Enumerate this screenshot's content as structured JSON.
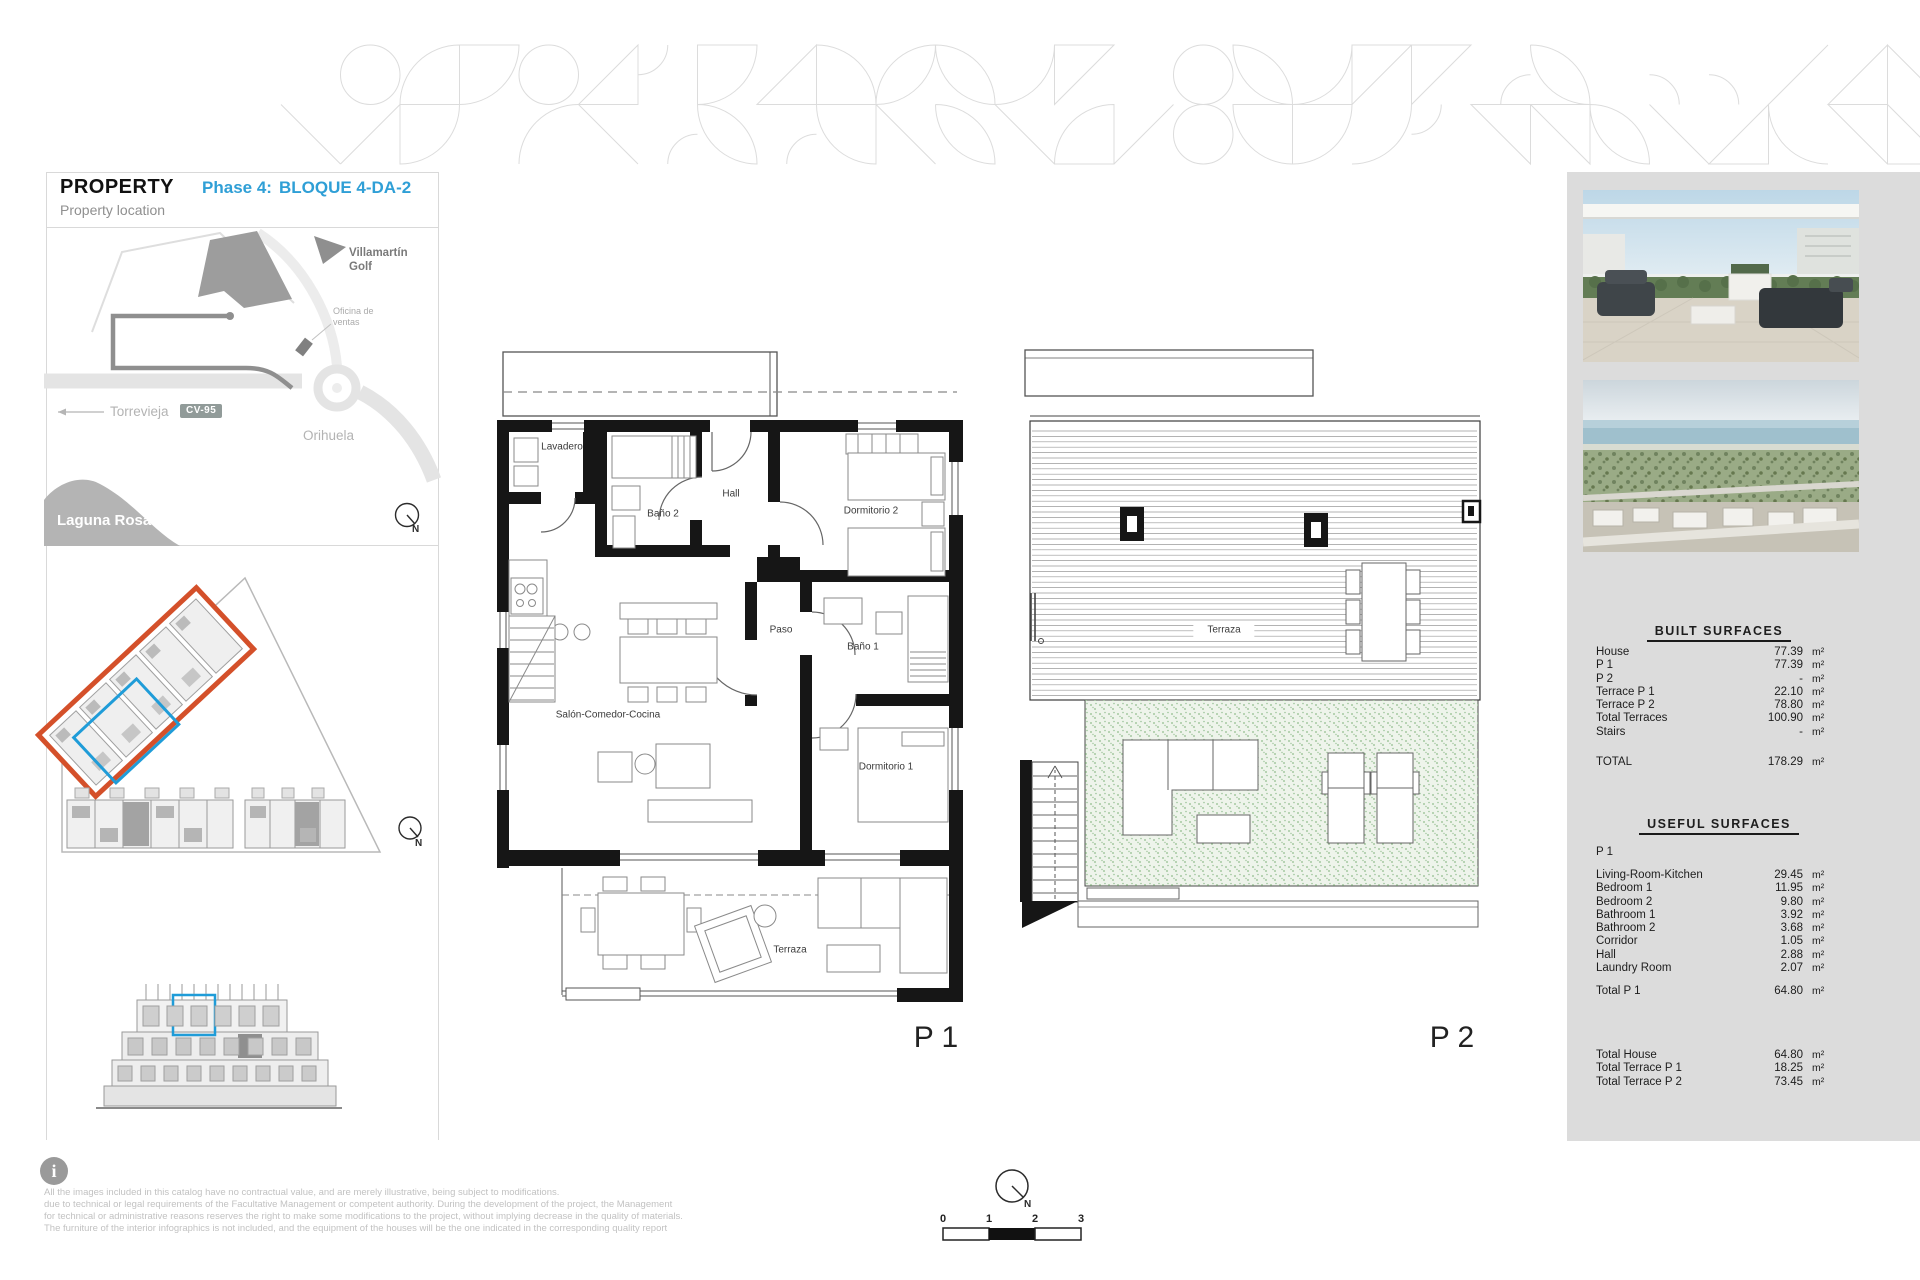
{
  "header": {
    "brand": "PROPERTY",
    "phase_label": "Phase 4:",
    "block_label": "BLOQUE 4-DA-2",
    "subtitle": "Property location"
  },
  "map": {
    "villamartin_line1": "Villamartín",
    "villamartin_line2": "Golf",
    "oficina_line1": "Oficina de",
    "oficina_line2": "ventas",
    "torrevieja": "Torrevieja",
    "road_badge": "CV-95",
    "orihuela": "Orihuela",
    "laguna": "Laguna Rosa",
    "n": "N"
  },
  "plans": {
    "p1": {
      "label": "P 1",
      "rooms": {
        "lavadero": "Lavadero",
        "bano2": "Baño 2",
        "hall": "Hall",
        "dormitorio2": "Dormitorio 2",
        "paso": "Paso",
        "bano1": "Baño 1",
        "dormitorio1": "Dormitorio 1",
        "salon": "Salón-Comedor-Cocina",
        "terraza": "Terraza"
      }
    },
    "p2": {
      "label": "P 2",
      "terraza": "Terraza"
    }
  },
  "built_surfaces": {
    "title": "BUILT SURFACES",
    "rows": [
      {
        "label": "House",
        "value": "77.39",
        "unit": "m²"
      },
      {
        "label": "P 1",
        "value": "77.39",
        "unit": "m²"
      },
      {
        "label": "P 2",
        "value": "-",
        "unit": "m²"
      },
      {
        "label": "Terrace P 1",
        "value": "22.10",
        "unit": "m²"
      },
      {
        "label": "Terrace P 2",
        "value": "78.80",
        "unit": "m²"
      },
      {
        "label": "Total Terraces",
        "value": "100.90",
        "unit": "m²"
      },
      {
        "label": "Stairs",
        "value": "-",
        "unit": "m²"
      }
    ],
    "total": {
      "label": "TOTAL",
      "value": "178.29",
      "unit": "m²"
    }
  },
  "useful_surfaces": {
    "title": "USEFUL SURFACES",
    "section": "P 1",
    "rows": [
      {
        "label": "Living-Room-Kitchen",
        "value": "29.45",
        "unit": "m²"
      },
      {
        "label": "Bedroom 1",
        "value": "11.95",
        "unit": "m²"
      },
      {
        "label": "Bedroom 2",
        "value": "9.80",
        "unit": "m²"
      },
      {
        "label": "Bathroom 1",
        "value": "3.92",
        "unit": "m²"
      },
      {
        "label": "Bathroom 2",
        "value": "3.68",
        "unit": "m²"
      },
      {
        "label": "Corridor",
        "value": "1.05",
        "unit": "m²"
      },
      {
        "label": "Hall",
        "value": "2.88",
        "unit": "m²"
      },
      {
        "label": "Laundry Room",
        "value": "2.07",
        "unit": "m²"
      }
    ],
    "total": {
      "label": "Total P 1",
      "value": "64.80",
      "unit": "m²"
    }
  },
  "summary_totals": {
    "rows": [
      {
        "label": "Total House",
        "value": "64.80",
        "unit": "m²"
      },
      {
        "label": "Total Terrace P 1",
        "value": "18.25",
        "unit": "m²"
      },
      {
        "label": "Total Terrace P 2",
        "value": "73.45",
        "unit": "m²"
      }
    ]
  },
  "disclaimer": {
    "lines": [
      "All the images included in this catalog have no contractual value, and are merely illustrative, being subject to modifications.",
      "due to technical or legal requirements of the Facultative Management or competent authority. During the development of the project, the Management",
      "for technical or administrative reasons reserves the right to make some modifications to the project, without implying decrease in the quality of materials.",
      "The furniture of the interior infographics is not included, and the equipment of the houses will be the one indicated in the corresponding quality report"
    ]
  },
  "scale_bar": {
    "ticks": [
      "0",
      "1",
      "2",
      "3"
    ],
    "n": "N"
  },
  "colors": {
    "accent_blue": "#2f9fd6",
    "highlight_orange": "#d4502a",
    "highlight_blue": "#1f9cd8",
    "panel_gray": "#dcdcdc",
    "terrace_green": "#eef4eb"
  }
}
